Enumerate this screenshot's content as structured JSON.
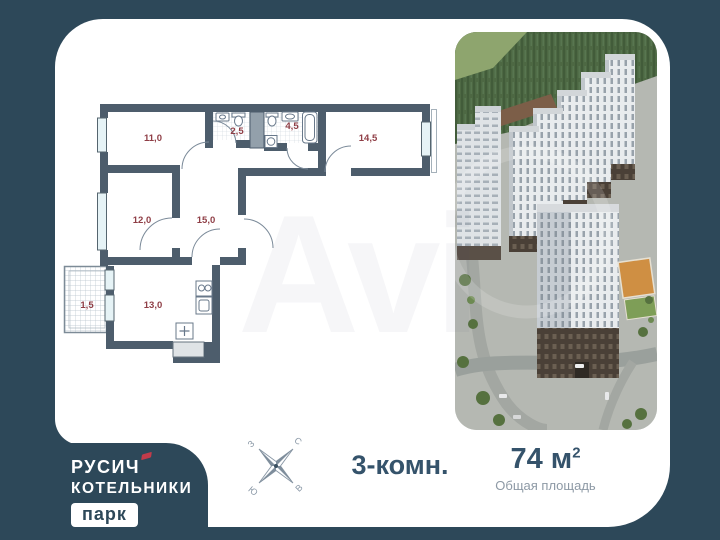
{
  "colors": {
    "background": "#2d4859",
    "card": "#ffffff",
    "plan_wall": "#4d5d6c",
    "room_label": "#8f3e46",
    "text_primary": "#35536b",
    "text_muted": "#8d99a5",
    "logo_accent": "#c23b4a"
  },
  "plan": {
    "rooms": [
      {
        "id": "room-11",
        "area": "11,0"
      },
      {
        "id": "wc",
        "area": "2,5"
      },
      {
        "id": "bathroom",
        "area": "4,5"
      },
      {
        "id": "room-14",
        "area": "14,5"
      },
      {
        "id": "room-12",
        "area": "12,0"
      },
      {
        "id": "hall",
        "area": "15,0"
      },
      {
        "id": "balcony",
        "area": "1,5"
      },
      {
        "id": "kitchen",
        "area": "13,0"
      }
    ]
  },
  "compass": {
    "north": "С",
    "east": "В",
    "south": "Ю",
    "west": "З"
  },
  "summary": {
    "rooms_label": "3-комн.",
    "area_value": "74",
    "area_unit": " м",
    "area_exponent": "2",
    "area_caption": "Общая площадь"
  },
  "logo": {
    "line1": "РУСИЧ",
    "line2": "КОТЕЛЬНИКИ",
    "badge": "парк"
  },
  "watermark": "Avi"
}
